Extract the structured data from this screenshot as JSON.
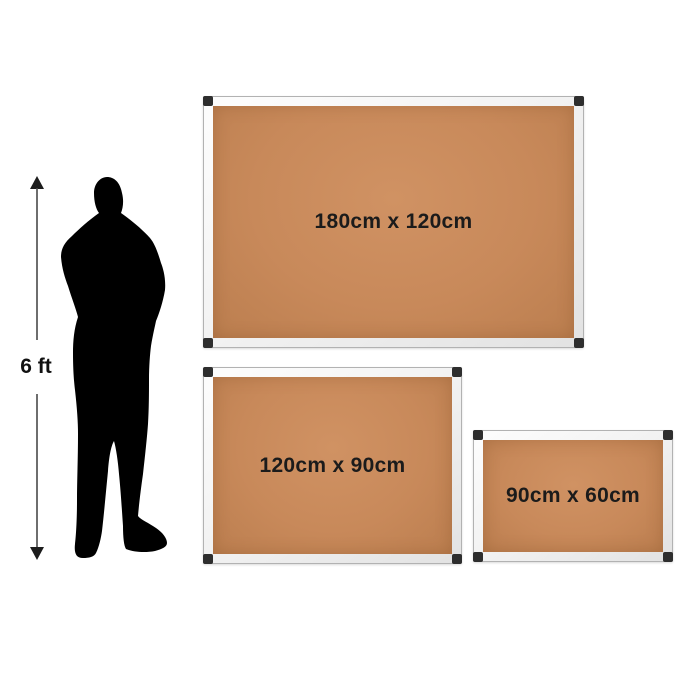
{
  "comparison": {
    "reference": {
      "label": "6 ft",
      "figure": "standing-man-silhouette-arms-crossed"
    },
    "boards": [
      {
        "name": "large",
        "label": "180cm x 120cm"
      },
      {
        "name": "medium",
        "label": "120cm x 90cm"
      },
      {
        "name": "small",
        "label": "90cm x 60cm"
      }
    ],
    "colors": {
      "background": "#ffffff",
      "cork": "#c8895a",
      "frame": "#f0f0f0",
      "frame_border": "#b2b2b2",
      "corner_cap": "#2e2e2e",
      "label_text": "#1b1b1b",
      "arrow": "#3a3a3a",
      "silhouette": "#000000"
    }
  }
}
